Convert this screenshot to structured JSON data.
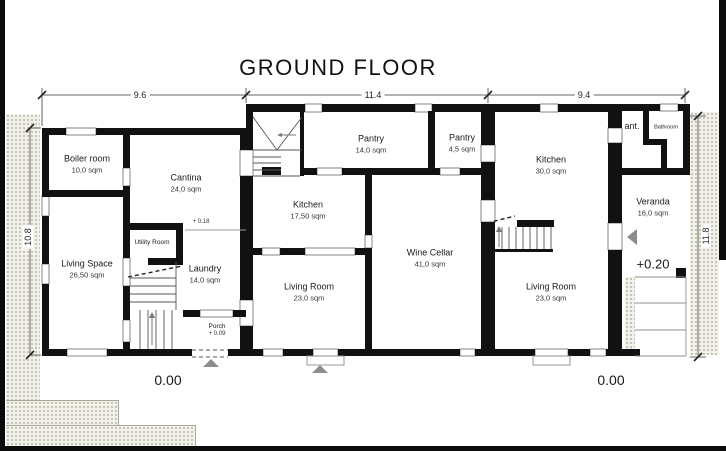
{
  "title": "GROUND FLOOR",
  "dimensions": {
    "width_left": "9.6",
    "width_middle": "11.4",
    "width_right": "9.4",
    "height_left": "10.8",
    "height_right": "11.8"
  },
  "levels": {
    "ground_left": "0.00",
    "ground_right": "0.00",
    "veranda": "+0.20",
    "laundry_step": "+ 0.18"
  },
  "rooms": {
    "boiler_room": {
      "name": "Boiler room",
      "area": "10,0 sqm"
    },
    "cantina": {
      "name": "Cantina",
      "area": "24,0 sqm"
    },
    "living_space": {
      "name": "Living Space",
      "area": "26,50 sqm"
    },
    "utility_room": {
      "name": "Utility Room"
    },
    "laundry": {
      "name": "Laundry",
      "area": "14,0 sqm"
    },
    "porch": {
      "name": "Porch",
      "level": "+ 0.09"
    },
    "kitchen_small": {
      "name": "Kitchen",
      "area": "17,50 sqm"
    },
    "pantry_large": {
      "name": "Pantry",
      "area": "14,0 sqm"
    },
    "pantry_small": {
      "name": "Pantry",
      "area": "4,5 sqm"
    },
    "living_room_middle": {
      "name": "Living Room",
      "area": "23,0 sqm"
    },
    "wine_cellar": {
      "name": "Wine Cellar",
      "area": "41,0 sqm"
    },
    "kitchen_large": {
      "name": "Kitchen",
      "area": "30,0 sqm"
    },
    "living_room_right": {
      "name": "Living Room",
      "area": "23,0 sqm"
    },
    "anteroom": {
      "name": "ant."
    },
    "bathroom": {
      "name": "Bathroom"
    },
    "veranda": {
      "name": "Veranda",
      "area": "16,0 sqm"
    }
  },
  "colors": {
    "wall": "#111111",
    "paper": "#ffffff",
    "marker": "#8a8f8a",
    "terrain": "#f3f2ea"
  }
}
